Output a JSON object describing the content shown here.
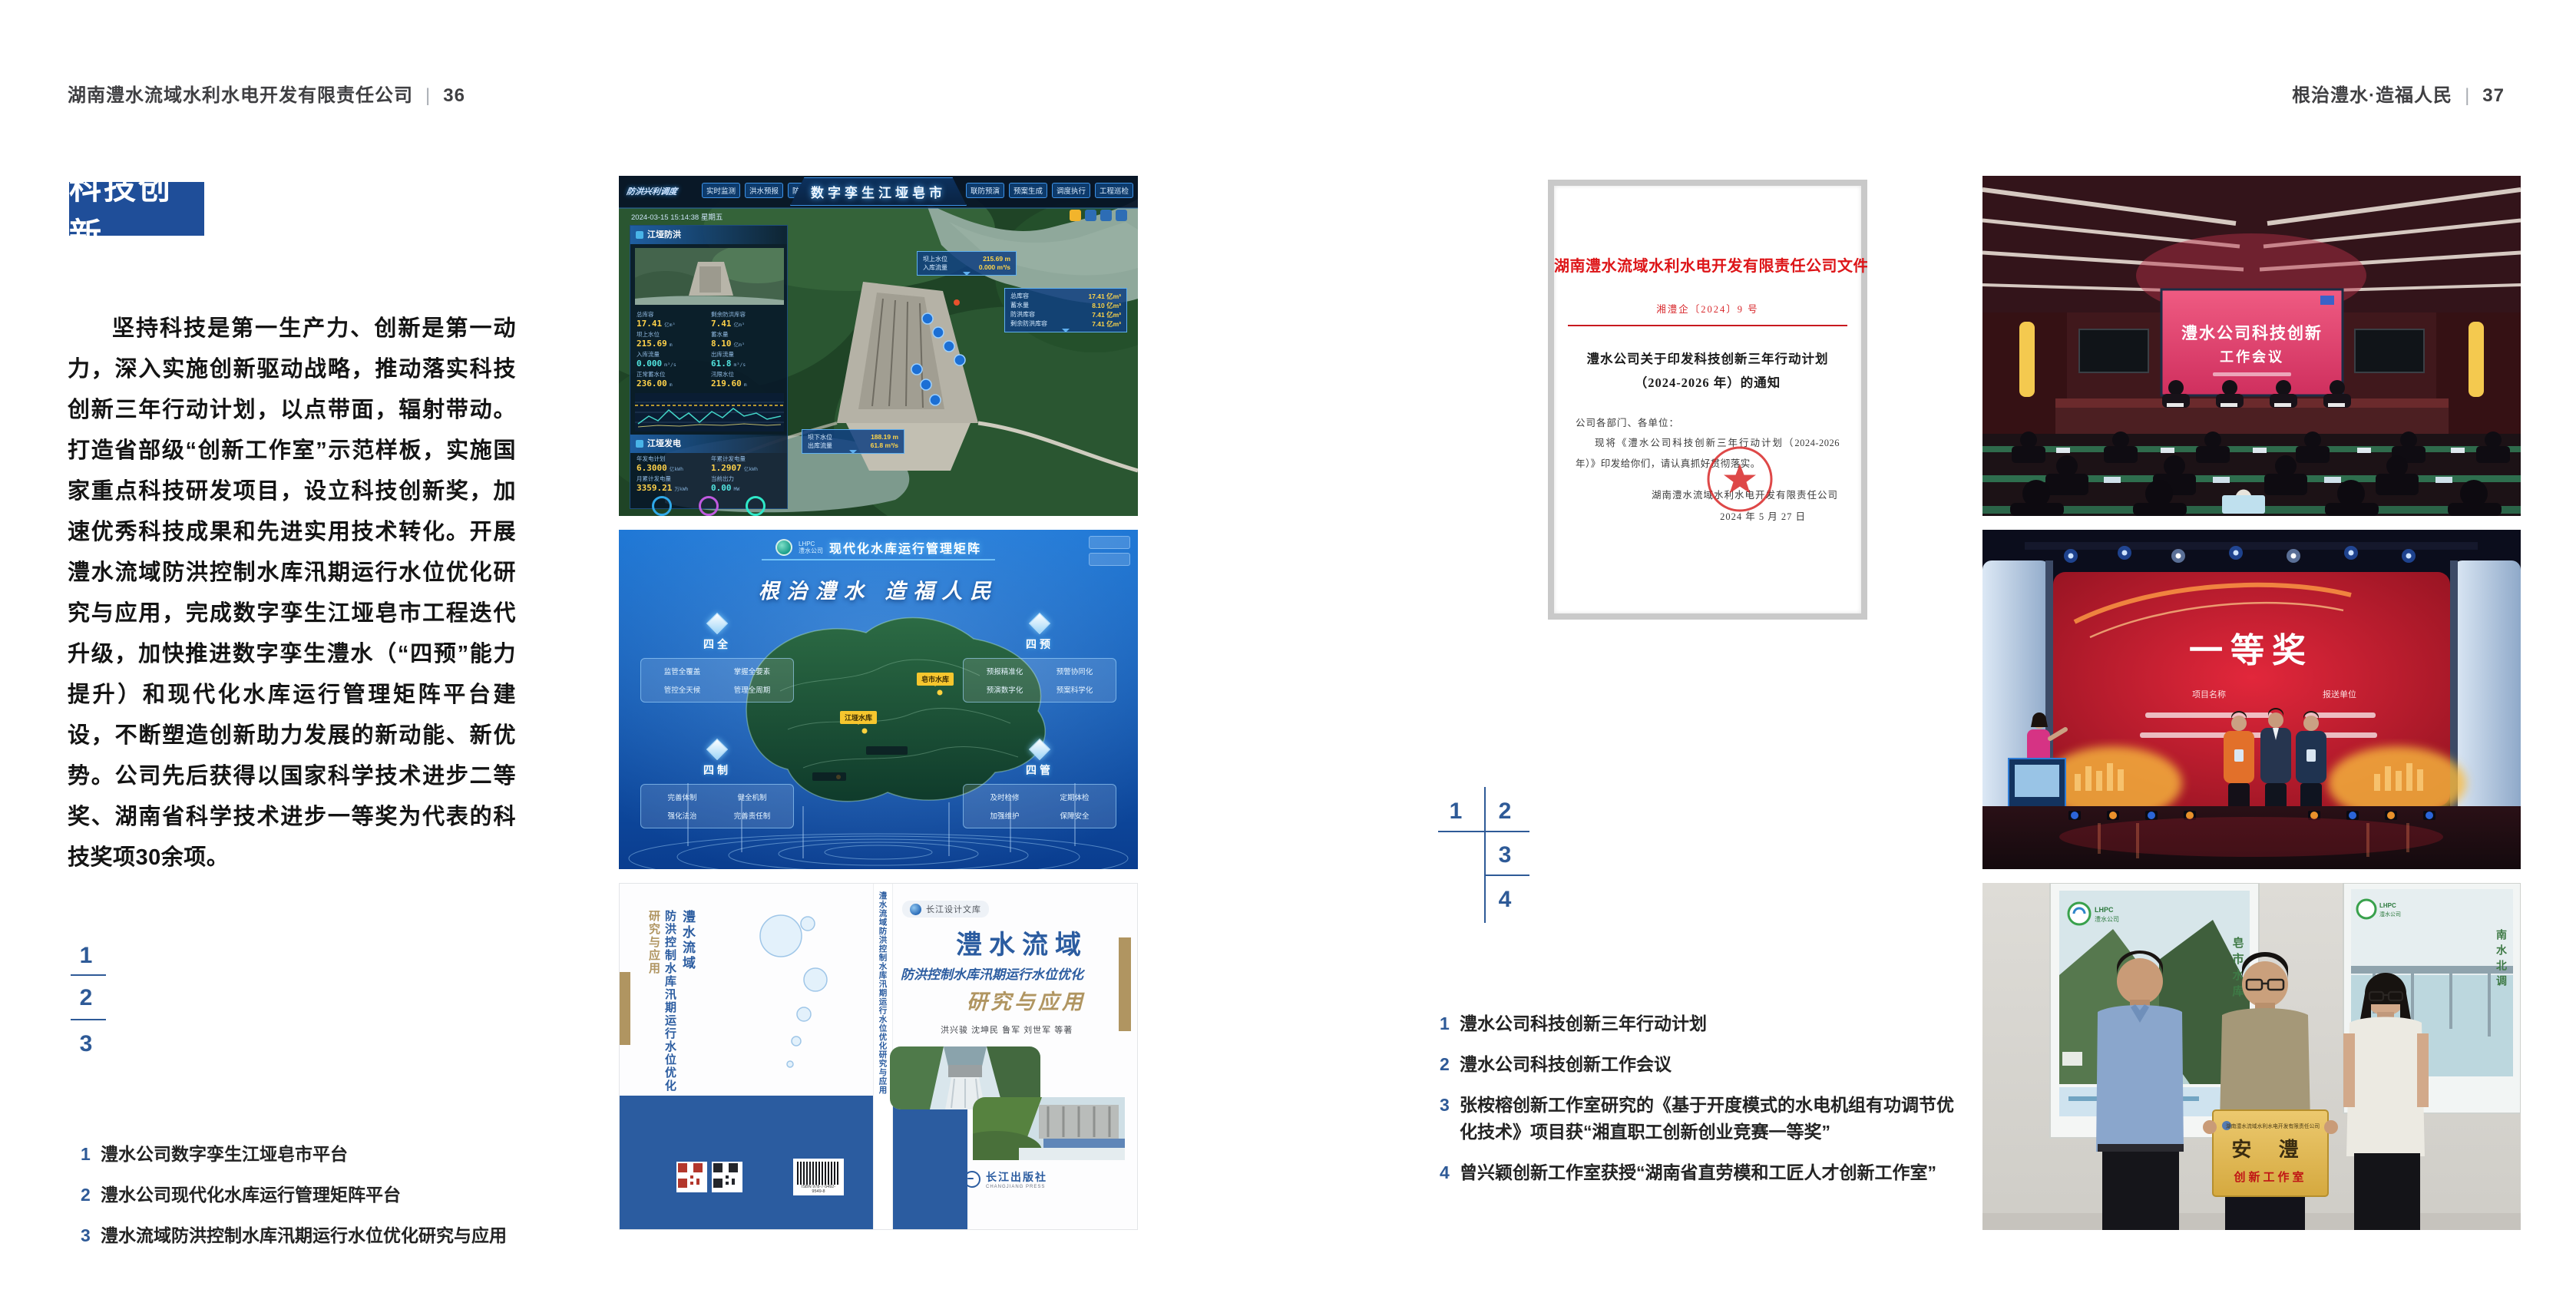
{
  "colors": {
    "accent_blue": "#1f4e99",
    "marker_blue": "#2e5a97",
    "doc_red": "#dd1518",
    "book_blue": "#2b5ca0",
    "book_tan": "#b09561"
  },
  "left_page": {
    "header": {
      "company": "湖南澧水流域水利水电开发有限责任公司",
      "separator": "|",
      "page_number": "36"
    },
    "badge": "科技创新",
    "paragraph": "坚持科技是第一生产力、创新是第一动力，深入实施创新驱动战略，推动落实科技创新三年行动计划，以点带面，辐射带动。打造省部级“创新工作室”示范样板，实施国家重点科技研发项目，设立科技创新奖，加速优秀科技成果和先进实用技术转化。开展澧水流域防洪控制水库汛期运行水位优化研究与应用，完成数字孪生江垭皂市工程迭代升级，加快推进数字孪生澧水（“四预”能力提升）和现代化水库运行管理矩阵平台建设，不断塑造创新助力发展的新动能、新优势。公司先后获得以国家科学技术进步二等奖、湖南省科学技术进步一等奖为代表的科技奖项30余项。",
    "figure_markers": [
      "1",
      "2",
      "3"
    ],
    "captions": [
      {
        "no": "1",
        "text": "澧水公司数字孪生江垭皂市平台"
      },
      {
        "no": "2",
        "text": "澧水公司现代化水库运行管理矩阵平台"
      },
      {
        "no": "3",
        "text": "澧水流域防洪控制水库汛期运行水位优化研究与应用"
      }
    ]
  },
  "right_page": {
    "header": {
      "slogan": "根治澧水·造福人民",
      "separator": "|",
      "page_number": "37"
    },
    "figure_markers": [
      "1",
      "2",
      "3",
      "4"
    ],
    "captions": [
      {
        "no": "1",
        "text": "澧水公司科技创新三年行动计划"
      },
      {
        "no": "2",
        "text": "澧水公司科技创新工作会议"
      },
      {
        "no": "3",
        "text": "张桉榕创新工作室研究的《基于开度模式的水电机组有功调节优化技术》项目获“湘直职工创新创业竞赛一等奖”"
      },
      {
        "no": "4",
        "text": "曾兴颖创新工作室获授“湖南省直劳模和工匠人才创新工作室”"
      }
    ]
  },
  "dashboard": {
    "title": "数字孪生江垭皂市",
    "module_label": "防洪兴利调度",
    "datetime": "2024-03-15 15:14:38 星期五",
    "tabs_left": [
      "实时监测",
      "洪水预报",
      "防洪预警"
    ],
    "tabs_right": [
      "联防预演",
      "预案生成",
      "调度执行",
      "工程巡检"
    ],
    "panel_flood": {
      "title": "江垭防洪",
      "stats": [
        {
          "label": "总库容",
          "value": "17.41",
          "unit": "亿m³"
        },
        {
          "label": "剩余防洪库容",
          "value": "7.41",
          "unit": "亿m³"
        },
        {
          "label": "坝上水位",
          "value": "215.69",
          "unit": "m"
        },
        {
          "label": "蓄水量",
          "value": "8.10",
          "unit": "亿m³"
        },
        {
          "label": "入库流量",
          "value": "0.000",
          "unit": "m³/s"
        },
        {
          "label": "出库流量",
          "value": "61.8",
          "unit": "m³/s"
        },
        {
          "label": "正常蓄水位",
          "value": "236.00",
          "unit": "m"
        },
        {
          "label": "汛限水位",
          "value": "219.60",
          "unit": "m"
        }
      ]
    },
    "panel_power": {
      "title": "江垭发电",
      "stats": [
        {
          "label": "年发电计划",
          "value": "6.3000",
          "unit": "亿kWh"
        },
        {
          "label": "年累计发电量",
          "value": "1.2907",
          "unit": "亿kWh"
        },
        {
          "label": "月累计发电量",
          "value": "3359.21",
          "unit": "万kWh"
        },
        {
          "label": "当前出力",
          "value": "0.00",
          "unit": "MW"
        }
      ],
      "donut_values": [
        "0.00",
        "102.98",
        "0.00"
      ]
    },
    "tooltip_up": [
      {
        "label": "坝上水位",
        "value": "215.69 m"
      },
      {
        "label": "入库流量",
        "value": "0.000 m³/s"
      }
    ],
    "tooltip_res": [
      {
        "label": "总库容",
        "value": "17.41 亿m³"
      },
      {
        "label": "蓄水量",
        "value": "8.10 亿m³"
      },
      {
        "label": "防洪库容",
        "value": "7.41 亿m³"
      },
      {
        "label": "剩余防洪库容",
        "value": "7.41 亿m³"
      }
    ],
    "tooltip_down": [
      {
        "label": "坝下水位",
        "value": "188.19 m"
      },
      {
        "label": "出库流量",
        "value": "61.8 m³/s"
      }
    ]
  },
  "matrix": {
    "title": "现代化水库运行管理矩阵",
    "logo_abbr": "LHPC",
    "logo_name": "澧水公司",
    "slogan": "根治澧水 造福人民",
    "groups": [
      {
        "name": "四全",
        "items": [
          "监管全覆盖",
          "掌握全要素",
          "管控全天候",
          "管理全周期"
        ]
      },
      {
        "name": "四预",
        "items": [
          "预报精准化",
          "预警协同化",
          "预演数字化",
          "预案科学化"
        ]
      },
      {
        "name": "四制",
        "items": [
          "完善体制",
          "健全机制",
          "强化法治",
          "完善责任制"
        ]
      },
      {
        "name": "四管",
        "items": [
          "及时检修",
          "定期体检",
          "加强维护",
          "保障安全"
        ]
      }
    ],
    "marker_zaoshi": "皂市水库",
    "marker_jiangya": "江垭水库"
  },
  "book": {
    "series": "长江设计文库",
    "title_main": "澧水流域",
    "title_sub": "防洪控制水库汛期运行水位优化",
    "title_tail": "研究与应用",
    "authors": "洪兴骏  沈坤民  鲁军  刘世军  等著",
    "publisher": "长江出版社",
    "publisher_en": "CHANGJIANG PRESS",
    "spine_title": "澧水流域防洪控制水库汛期运行水位优化研究与应用"
  },
  "document": {
    "header": "湖南澧水流域水利水电开发有限责任公司文件",
    "doc_no": "湘澧企〔2024〕9 号",
    "title_line1": "澧水公司关于印发科技创新三年行动计划",
    "title_line2": "（2024-2026 年）的通知",
    "salutation": "公司各部门、各单位：",
    "body": "现将《澧水公司科技创新三年行动计划（2024-2026 年）》印发给你们，请认真抓好贯彻落实。",
    "signer": "湖南澧水流域水利水电开发有限责任公司",
    "date": "2024 年 5 月 27 日"
  },
  "conference": {
    "screen_line1": "澧水公司科技创新",
    "screen_line2": "工作会议"
  },
  "award": {
    "title": "一等奖",
    "col_left": "项目名称",
    "col_right": "报送单位"
  },
  "plaque": {
    "org": "湖南澧水流域水利水电开发有限责任公司",
    "name": "安  澧",
    "workshop": "创新工作室",
    "poster_left_caption": "皂市水库",
    "poster_right_caption": "南水北调",
    "lhpc_abbr": "LHPC",
    "lhpc_name": "澧水公司"
  }
}
